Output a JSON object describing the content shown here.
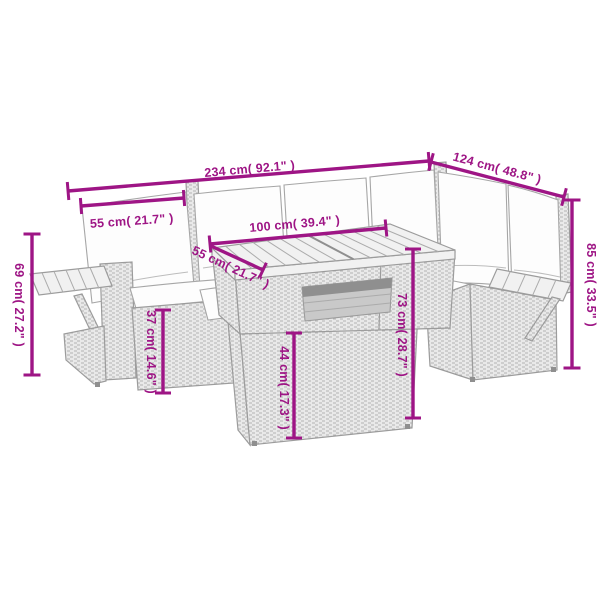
{
  "image": {
    "type": "product-dimension-diagram",
    "subject": "rattan corner garden lounge set with white cushions, armrest trays and slatted two-part table"
  },
  "colors": {
    "background": "#ffffff",
    "dimension_accent": "#9e1585",
    "linework_gray": "#9c9c9c"
  },
  "dimensions": [
    {
      "name": "overall-width",
      "label": "234 cm( 92.1\" )",
      "orientation": "horizontal"
    },
    {
      "name": "overall-depth",
      "label": "124 cm( 48.8\" )",
      "orientation": "diagonal"
    },
    {
      "name": "backrest-width",
      "label": "55 cm( 21.7\" )",
      "orientation": "horizontal"
    },
    {
      "name": "table-length",
      "label": "100 cm( 39.4\" )",
      "orientation": "horizontal"
    },
    {
      "name": "table-depth",
      "label": "55 cm( 21.7\" )",
      "orientation": "diagonal"
    },
    {
      "name": "armrest-height",
      "label": "69 cm( 27.2\" )",
      "orientation": "vertical"
    },
    {
      "name": "backrest-height",
      "label": "85 cm( 33.5\" )",
      "orientation": "vertical"
    },
    {
      "name": "seat-height",
      "label": "37 cm( 14.6\" )",
      "orientation": "vertical"
    },
    {
      "name": "table-base-height",
      "label": "44 cm( 17.3\" )",
      "orientation": "vertical"
    },
    {
      "name": "table-height",
      "label": "73 cm( 28.7\" )",
      "orientation": "vertical"
    }
  ]
}
